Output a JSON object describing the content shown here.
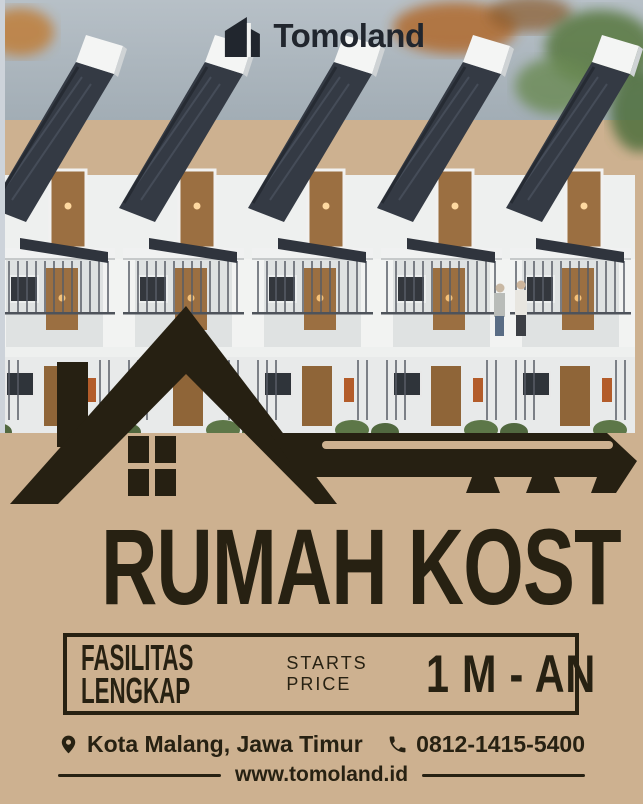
{
  "brand": {
    "name": "Tomoland",
    "logo_icon": "building-mark-icon"
  },
  "hero": {
    "alt": "row of modern three-story kost townhouses with dark pitched roofs, white facades, wooden doors and balconies"
  },
  "graphic": {
    "name": "house-key-silhouette"
  },
  "title": "RUMAH KOST",
  "feature_box": {
    "feature_line1": "FASILITAS",
    "feature_line2": "LENGKAP",
    "price_label_line1": "STARTS",
    "price_label_line2": "PRICE",
    "price_value": "1 M - AN"
  },
  "contact": {
    "location": "Kota Malang, Jawa Timur",
    "phone": "0812-1415-5400",
    "website": "www.tomoland.id"
  },
  "colors": {
    "tan": "#cdb190",
    "ink": "#272112",
    "silhouette": "#262012",
    "logo": "#21262e"
  }
}
